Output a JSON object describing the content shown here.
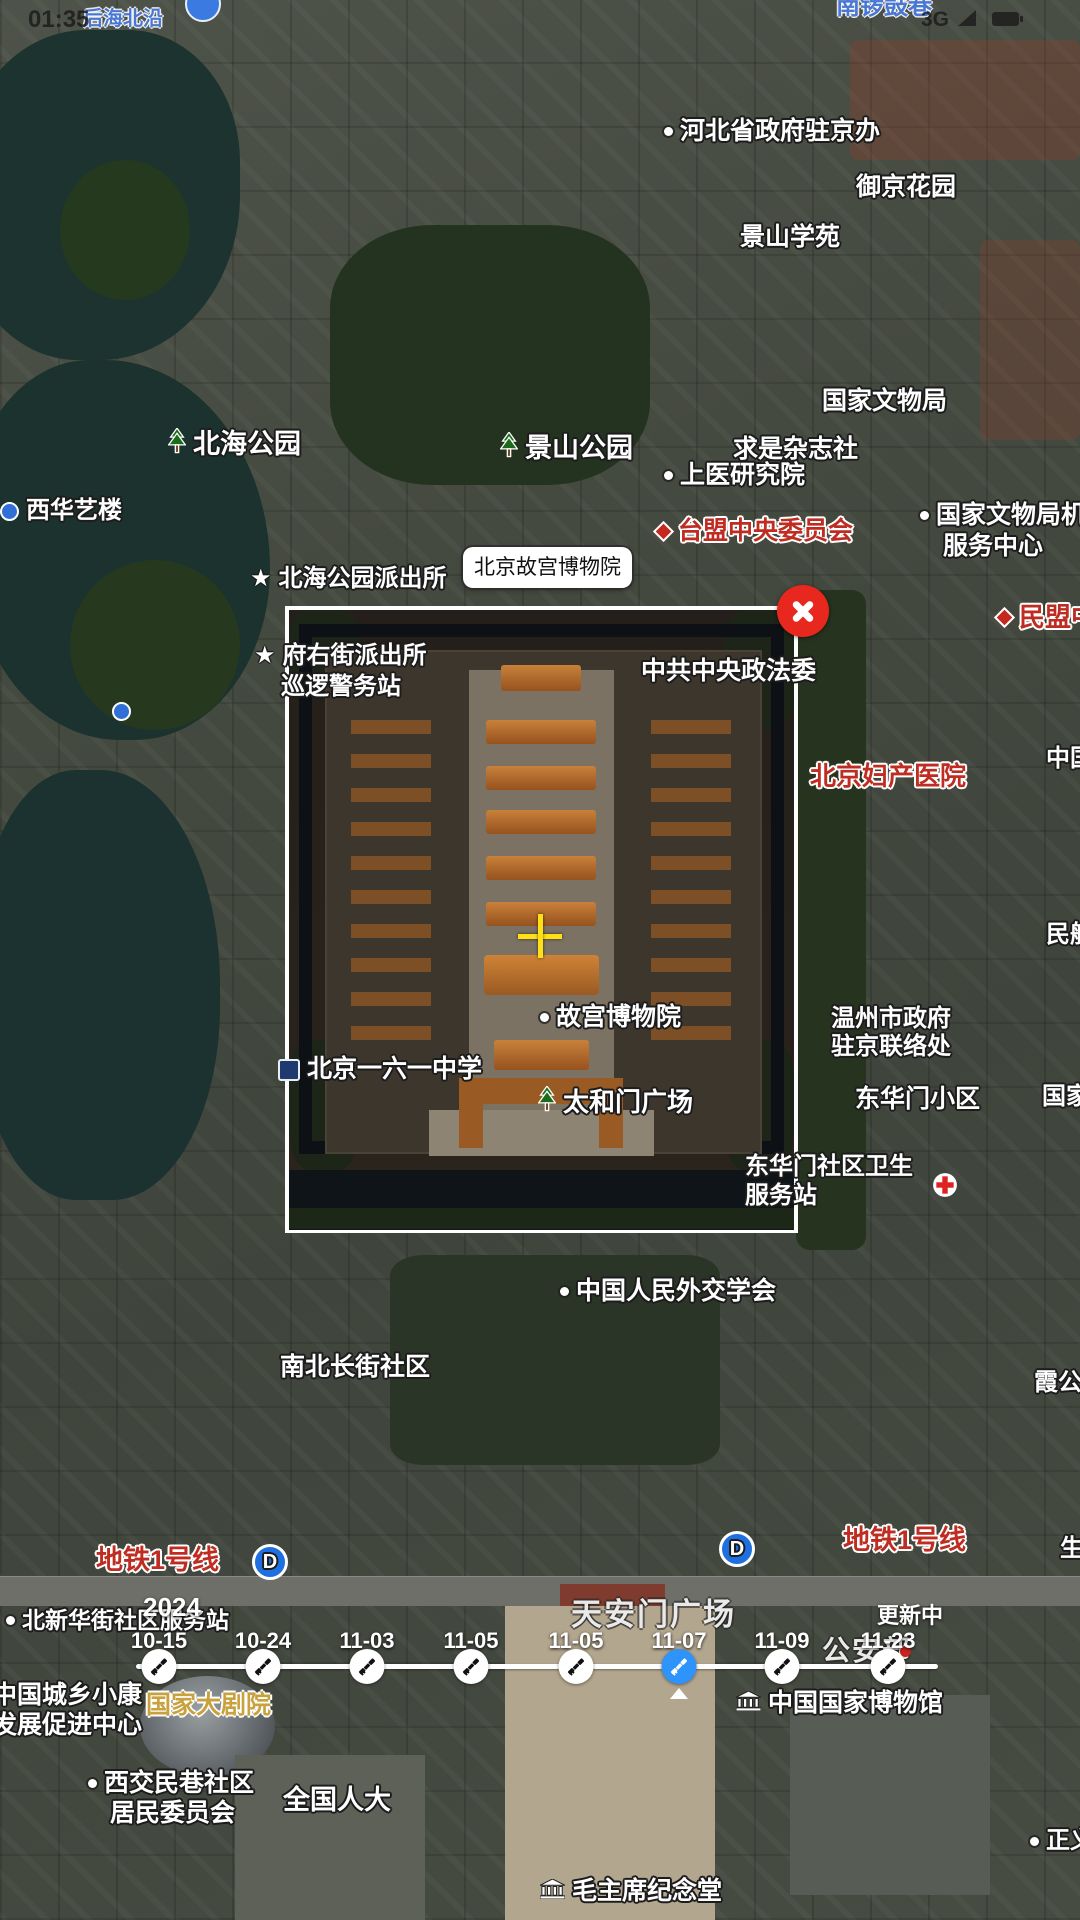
{
  "status_bar": {
    "time": "01:35",
    "network": "3G"
  },
  "selection": {
    "label": "北京故宫博物院"
  },
  "timeline": {
    "year": "2024",
    "status": "更新中",
    "dates": [
      {
        "label": "10-15",
        "x": 159,
        "selected": false
      },
      {
        "label": "10-24",
        "x": 263,
        "selected": false
      },
      {
        "label": "11-03",
        "x": 367,
        "selected": false
      },
      {
        "label": "11-05",
        "x": 471,
        "selected": false
      },
      {
        "label": "11-05",
        "x": 576,
        "selected": false
      },
      {
        "label": "11-07",
        "x": 679,
        "selected": true
      },
      {
        "label": "11-09",
        "x": 782,
        "selected": false
      },
      {
        "label": "11-23",
        "x": 888,
        "selected": false
      }
    ]
  },
  "colors": {
    "selected_dot": "#2e93fa",
    "close_button": "#e8281e",
    "crosshair": "#ffe014",
    "red_label": "#bf2d22",
    "blue_label": "#4a77d4",
    "gold_label": "#c9a23e"
  },
  "map_labels": [
    {
      "text": "后海北沿",
      "x": 83,
      "y": 8,
      "fs": 20,
      "style": "blue"
    },
    {
      "text": "南锣鼓巷",
      "x": 836,
      "y": -6,
      "fs": 24,
      "style": "blue"
    },
    {
      "text": "",
      "x": 185,
      "y": -14,
      "fs": 24,
      "style": "white",
      "icon": "bluecircle"
    },
    {
      "text": "河北省政府驻京办",
      "x": 664,
      "y": 118,
      "fs": 25,
      "style": "white",
      "icon": "dot"
    },
    {
      "text": "御京花园",
      "x": 856,
      "y": 174,
      "fs": 25,
      "style": "white"
    },
    {
      "text": "景山学苑",
      "x": 740,
      "y": 224,
      "fs": 25,
      "style": "white"
    },
    {
      "text": "国家文物局",
      "x": 822,
      "y": 388,
      "fs": 25,
      "style": "white"
    },
    {
      "text": "求是杂志社",
      "x": 733,
      "y": 436,
      "fs": 25,
      "style": "white"
    },
    {
      "text": "上医研究院",
      "x": 664,
      "y": 462,
      "fs": 25,
      "style": "white",
      "icon": "dot"
    },
    {
      "text": "台盟中央委员会",
      "x": 656,
      "y": 518,
      "fs": 25,
      "style": "red",
      "icon": "diamond"
    },
    {
      "text": "国家文物局机关",
      "x": 920,
      "y": 502,
      "fs": 25,
      "style": "white",
      "icon": "dot"
    },
    {
      "text": "服务中心",
      "x": 943,
      "y": 533,
      "fs": 25,
      "style": "white"
    },
    {
      "text": "民盟中央",
      "x": 997,
      "y": 603,
      "fs": 26,
      "style": "red",
      "icon": "diamond"
    },
    {
      "text": "北海公园",
      "x": 168,
      "y": 428,
      "fs": 27,
      "style": "white",
      "icon": "tree"
    },
    {
      "text": "景山公园",
      "x": 500,
      "y": 432,
      "fs": 27,
      "style": "white",
      "icon": "tree"
    },
    {
      "text": "西华艺楼",
      "x": 0,
      "y": 498,
      "fs": 24,
      "style": "white",
      "icon": "bluedot"
    },
    {
      "text": "北海公园派出所",
      "x": 250,
      "y": 566,
      "fs": 24,
      "style": "white",
      "icon": "star"
    },
    {
      "text": "府右街派出所",
      "x": 254,
      "y": 643,
      "fs": 24,
      "style": "white",
      "icon": "star"
    },
    {
      "text": "巡逻警务站",
      "x": 281,
      "y": 674,
      "fs": 24,
      "style": "white"
    },
    {
      "text": "中共中央政法委",
      "x": 641,
      "y": 658,
      "fs": 25,
      "style": "white"
    },
    {
      "text": "",
      "x": 112,
      "y": 702,
      "fs": 24,
      "style": "white",
      "icon": "bluedot"
    },
    {
      "text": "北京妇产医院",
      "x": 810,
      "y": 762,
      "fs": 26,
      "style": "red"
    },
    {
      "text": "中国",
      "x": 1046,
      "y": 746,
      "fs": 24,
      "style": "white"
    },
    {
      "text": "民航",
      "x": 1046,
      "y": 922,
      "fs": 24,
      "style": "white"
    },
    {
      "text": "故宫博物院",
      "x": 540,
      "y": 1004,
      "fs": 25,
      "style": "white",
      "icon": "dot"
    },
    {
      "text": "温州市政府",
      "x": 831,
      "y": 1006,
      "fs": 24,
      "style": "white"
    },
    {
      "text": "驻京联络处",
      "x": 831,
      "y": 1034,
      "fs": 24,
      "style": "white"
    },
    {
      "text": "北京一六一中学",
      "x": 278,
      "y": 1056,
      "fs": 25,
      "style": "white",
      "icon": "school"
    },
    {
      "text": "东华门小区",
      "x": 855,
      "y": 1086,
      "fs": 25,
      "style": "white"
    },
    {
      "text": "国家",
      "x": 1042,
      "y": 1084,
      "fs": 24,
      "style": "white"
    },
    {
      "text": "太和门广场",
      "x": 538,
      "y": 1086,
      "fs": 26,
      "style": "white",
      "icon": "tree"
    },
    {
      "text": "东华门社区卫生",
      "x": 745,
      "y": 1154,
      "fs": 24,
      "style": "white"
    },
    {
      "text": "服务站",
      "x": 745,
      "y": 1183,
      "fs": 24,
      "style": "white"
    },
    {
      "text": "",
      "x": 932,
      "y": 1172,
      "fs": 24,
      "style": "white",
      "icon": "cross"
    },
    {
      "text": "中国人民外交学会",
      "x": 560,
      "y": 1278,
      "fs": 25,
      "style": "white",
      "icon": "dot"
    },
    {
      "text": "南北长街社区",
      "x": 280,
      "y": 1354,
      "fs": 25,
      "style": "white"
    },
    {
      "text": "霞公府",
      "x": 1034,
      "y": 1370,
      "fs": 24,
      "style": "white"
    },
    {
      "text": "地铁1号线",
      "x": 96,
      "y": 1546,
      "fs": 27,
      "style": "red"
    },
    {
      "text": "",
      "x": 252,
      "y": 1544,
      "fs": 24,
      "style": "white",
      "icon": "metro"
    },
    {
      "text": "",
      "x": 719,
      "y": 1531,
      "fs": 24,
      "style": "white",
      "icon": "metro"
    },
    {
      "text": "地铁1号线",
      "x": 843,
      "y": 1526,
      "fs": 27,
      "style": "red"
    },
    {
      "text": "生",
      "x": 1060,
      "y": 1536,
      "fs": 24,
      "style": "white"
    },
    {
      "text": "北新华街社区服务站",
      "x": 6,
      "y": 1608,
      "fs": 23,
      "style": "white",
      "icon": "dot"
    },
    {
      "text": "天安门广场",
      "x": 571,
      "y": 1598,
      "fs": 31,
      "style": "faint"
    },
    {
      "text": "公安部",
      "x": 822,
      "y": 1636,
      "fs": 28,
      "style": "faint"
    },
    {
      "text": "",
      "x": 900,
      "y": 1646,
      "fs": 24,
      "style": "white",
      "icon": "reddot"
    },
    {
      "text": "中国城乡小康",
      "x": -8,
      "y": 1682,
      "fs": 25,
      "style": "white"
    },
    {
      "text": "发展促进中心",
      "x": -8,
      "y": 1712,
      "fs": 25,
      "style": "white"
    },
    {
      "text": "国家大剧院",
      "x": 146,
      "y": 1692,
      "fs": 25,
      "style": "gold"
    },
    {
      "text": "中国国家博物馆",
      "x": 736,
      "y": 1690,
      "fs": 25,
      "style": "white",
      "icon": "museum"
    },
    {
      "text": "西交民巷社区",
      "x": 88,
      "y": 1770,
      "fs": 25,
      "style": "white",
      "icon": "dot"
    },
    {
      "text": "居民委员会",
      "x": 110,
      "y": 1800,
      "fs": 25,
      "style": "white"
    },
    {
      "text": "全国人大",
      "x": 283,
      "y": 1786,
      "fs": 27,
      "style": "white"
    },
    {
      "text": "正义",
      "x": 1030,
      "y": 1828,
      "fs": 24,
      "style": "white",
      "icon": "dot"
    },
    {
      "text": "毛主席纪念堂",
      "x": 540,
      "y": 1878,
      "fs": 25,
      "style": "white",
      "icon": "museum"
    }
  ]
}
